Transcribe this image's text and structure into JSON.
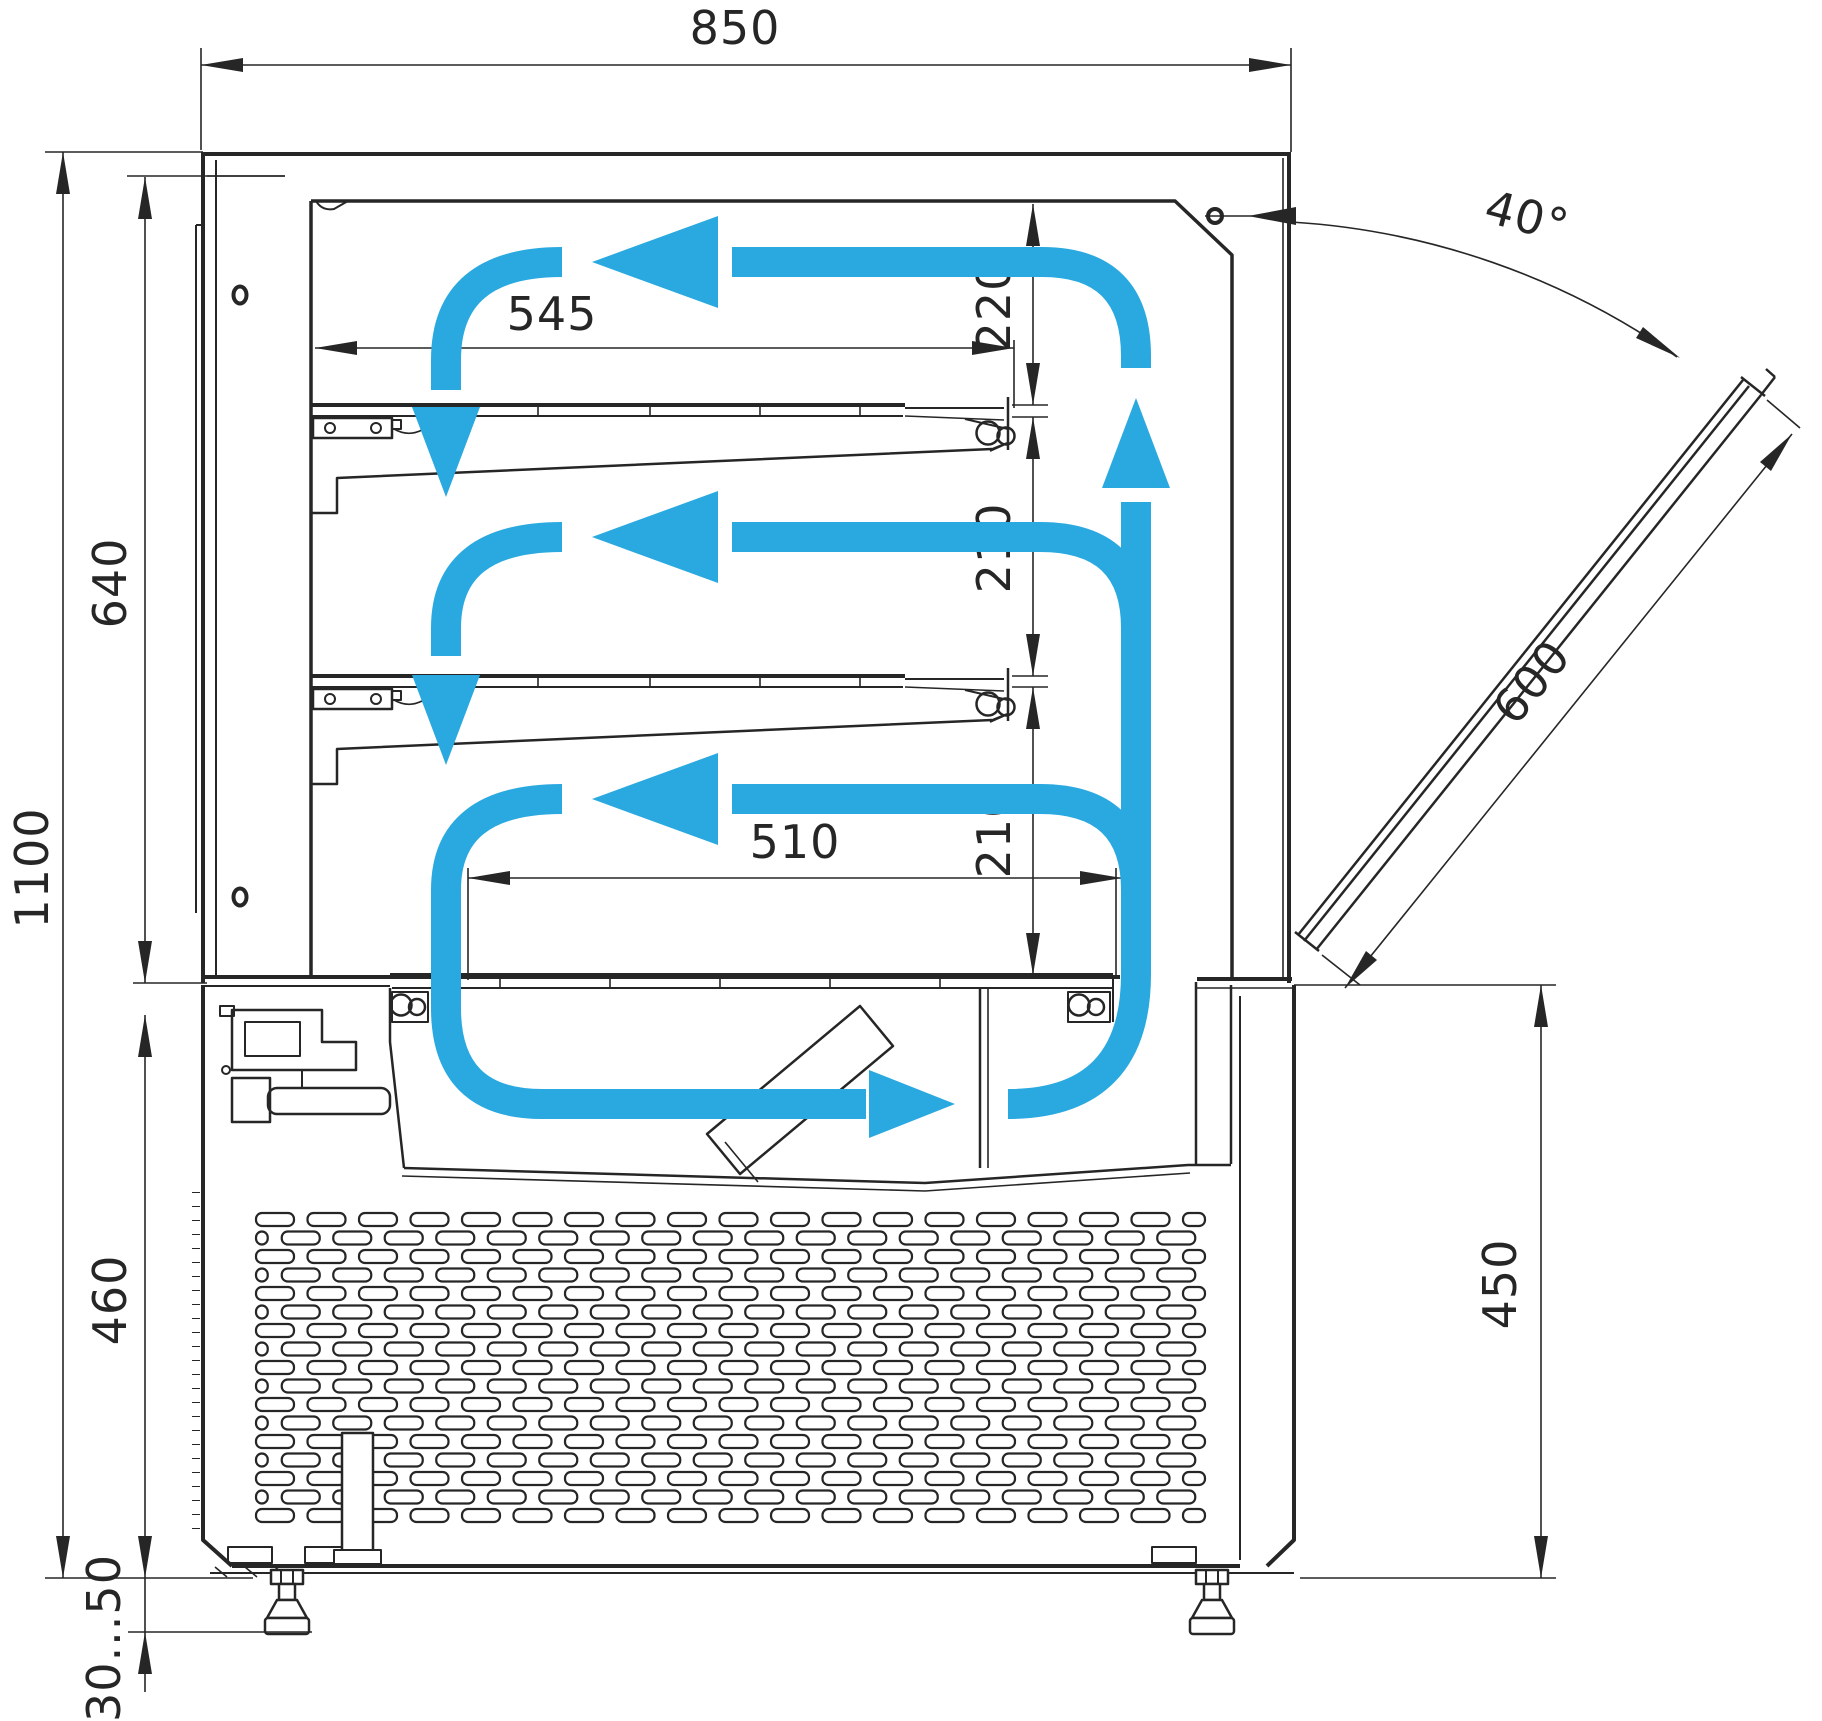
{
  "drawing": {
    "accent_color": "#2aa9e0",
    "line_color": "#262626",
    "dimensions": {
      "overall_width": {
        "label": "850"
      },
      "overall_height": {
        "label": "1100"
      },
      "display_section_height": {
        "label": "640"
      },
      "base_section_height": {
        "label": "460"
      },
      "leg_adjustment_range": {
        "label": "30...50"
      },
      "upper_shelf_length": {
        "label": "545"
      },
      "bottom_tray_length": {
        "label": "510"
      },
      "top_clearance": {
        "label": "220"
      },
      "middle_clearance": {
        "label": "210"
      },
      "lower_clearance": {
        "label": "210"
      },
      "door_opening_angle": {
        "label": "40°"
      },
      "glass_door_length": {
        "label": "600"
      },
      "base_front_height": {
        "label": "450"
      }
    }
  }
}
